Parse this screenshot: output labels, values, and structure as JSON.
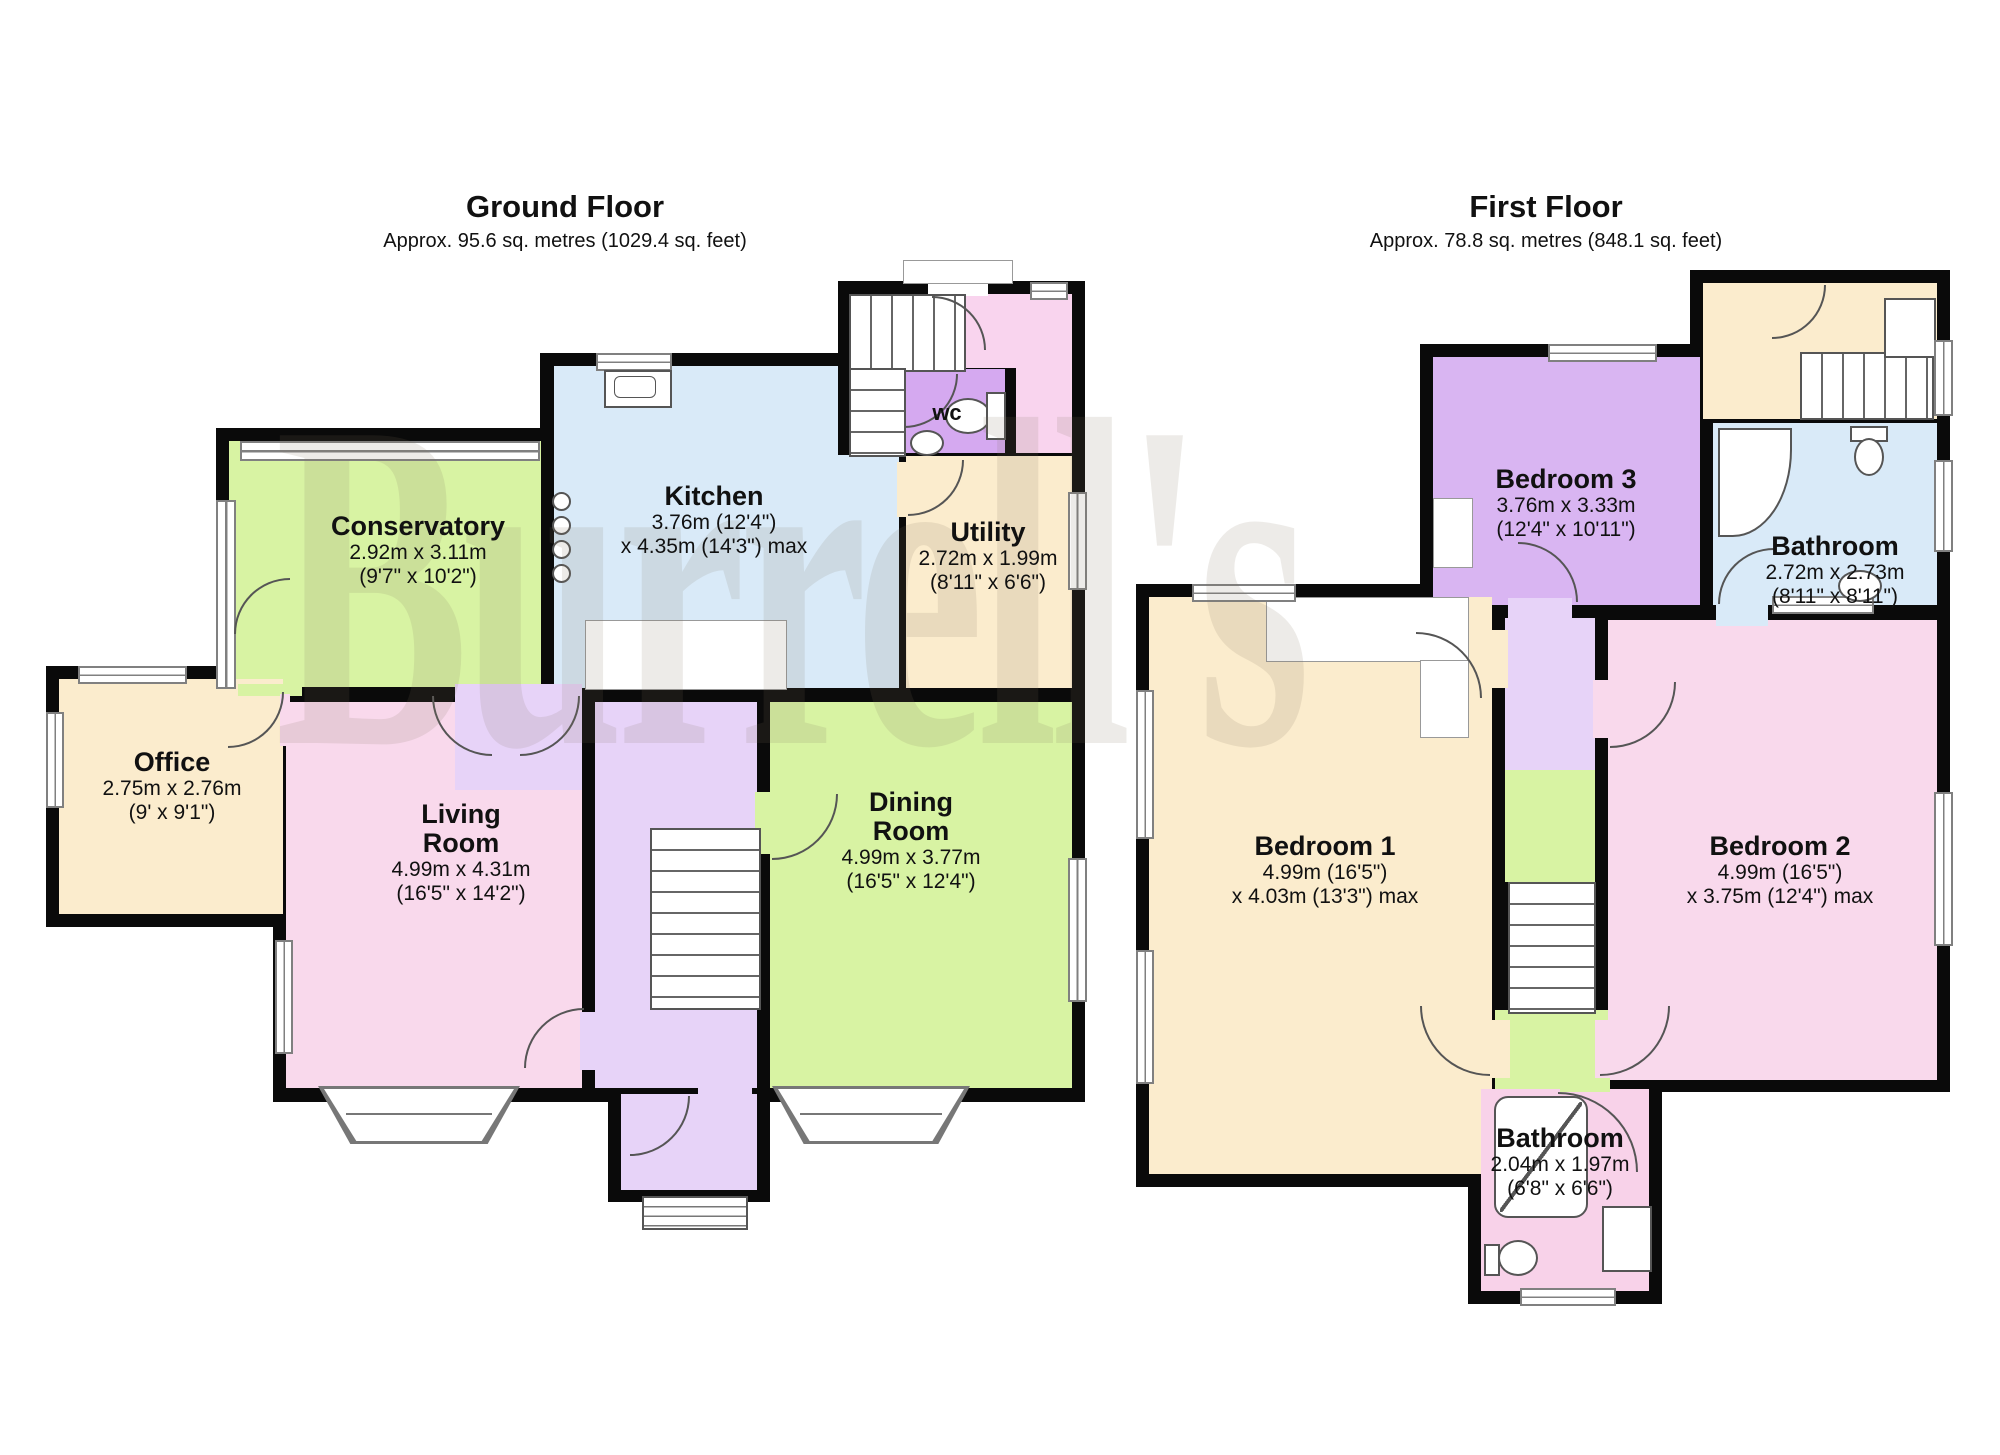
{
  "watermark": "Burrell's",
  "floors": {
    "ground": {
      "title": "Ground Floor",
      "subtitle": "Approx. 95.6 sq. metres (1029.4 sq. feet)",
      "rooms": {
        "conservatory": {
          "name": "Conservatory",
          "metric": "2.92m x 3.11m",
          "imperial": "(9'7\" x 10'2\")"
        },
        "kitchen": {
          "name": "Kitchen",
          "metric": "3.76m (12'4\")",
          "imperial": "x 4.35m (14'3\") max"
        },
        "utility": {
          "name": "Utility",
          "metric": "2.72m x 1.99m",
          "imperial": "(8'11\" x 6'6\")"
        },
        "wc": {
          "name": "wc"
        },
        "office": {
          "name": "Office",
          "metric": "2.75m x 2.76m",
          "imperial": "(9' x 9'1\")"
        },
        "living_room": {
          "name": "Living Room",
          "metric": "4.99m x 4.31m",
          "imperial": "(16'5\" x 14'2\")"
        },
        "dining_room": {
          "name": "Dining Room",
          "metric": "4.99m x 3.77m",
          "imperial": "(16'5\" x 12'4\")"
        }
      }
    },
    "first": {
      "title": "First Floor",
      "subtitle": "Approx. 78.8 sq. metres (848.1 sq. feet)",
      "rooms": {
        "bedroom_3": {
          "name": "Bedroom 3",
          "metric": "3.76m x 3.33m",
          "imperial": "(12'4\" x 10'11\")"
        },
        "bathroom_upper": {
          "name": "Bathroom",
          "metric": "2.72m x 2.73m",
          "imperial": "(8'11\" x 8'11\")"
        },
        "bedroom_1": {
          "name": "Bedroom 1",
          "metric": "4.99m (16'5\")",
          "imperial": "x 4.03m (13'3\") max"
        },
        "bedroom_2": {
          "name": "Bedroom 2",
          "metric": "4.99m (16'5\")",
          "imperial": "x 3.75m (12'4\") max"
        },
        "bathroom_lower": {
          "name": "Bathroom",
          "metric": "2.04m x 1.97m",
          "imperial": "(6'8\" x 6'6\")"
        }
      }
    }
  },
  "colors": {
    "wall": "#0a0a0a",
    "green": "#d8f3a3",
    "blue": "#d9eaf8",
    "cream": "#fbeccd",
    "pink": "#f9d9ec",
    "lavender": "#d9b5f2",
    "wc_purple": "#d5a9f0",
    "hall_purple": "#e7d3f8",
    "landing_pink": "#f9d4ee",
    "bathroom_pink": "#f8d2e9"
  }
}
